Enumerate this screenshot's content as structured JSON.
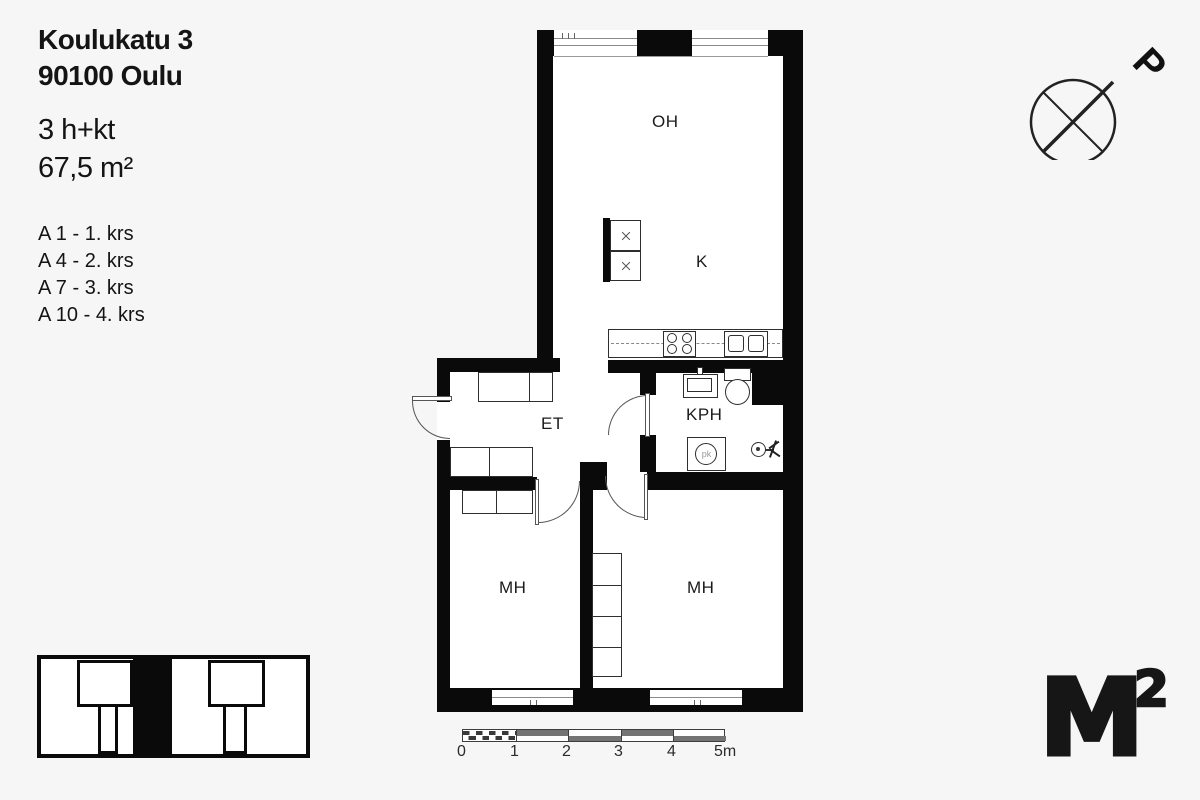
{
  "header": {
    "address_line1": "Koulukatu 3",
    "address_line2": "90100 Oulu",
    "layout": "3 h+kt",
    "area": "67,5 m²",
    "units": [
      "A 1 - 1. krs",
      "A 4 - 2. krs",
      "A 7 - 3. krs",
      "A 10 - 4. krs"
    ]
  },
  "compass": {
    "north_label": "P"
  },
  "plan": {
    "wall_color": "#0a0a0a",
    "rooms": [
      {
        "id": "oh",
        "label": "OH"
      },
      {
        "id": "k",
        "label": "K"
      },
      {
        "id": "et",
        "label": "ET"
      },
      {
        "id": "kph",
        "label": "KPH"
      },
      {
        "id": "mh1",
        "label": "MH"
      },
      {
        "id": "mh2",
        "label": "MH"
      }
    ],
    "washer_label": "pk"
  },
  "scalebar": {
    "labels": [
      "0",
      "1",
      "2",
      "3",
      "4",
      "5m"
    ]
  },
  "logo": {
    "letter": "M",
    "exponent": "2"
  }
}
